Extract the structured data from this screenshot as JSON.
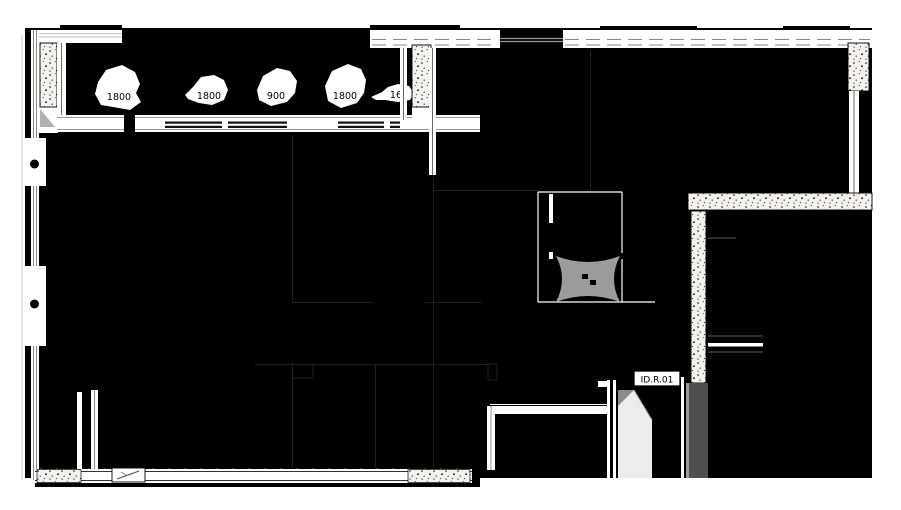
{
  "plan": {
    "annotations": {
      "window_labels": [
        "1800",
        "1800",
        "900",
        "1800",
        "167"
      ],
      "door_tag": "ID.R.01"
    },
    "colors": {
      "paper": "#ffffff",
      "body_black": "#000000",
      "line_white": "#ffffff",
      "wall_concrete_fill": "#f4f2ee",
      "elevator_symbol_gray": "#9c9c9c",
      "door_leaf_gray": "#ececec",
      "door_chamfer_gray": "#8b8b8b",
      "wall_shadow_gray": "#4f4f4f",
      "faint_partition_gray": "#1e1e1e"
    }
  }
}
